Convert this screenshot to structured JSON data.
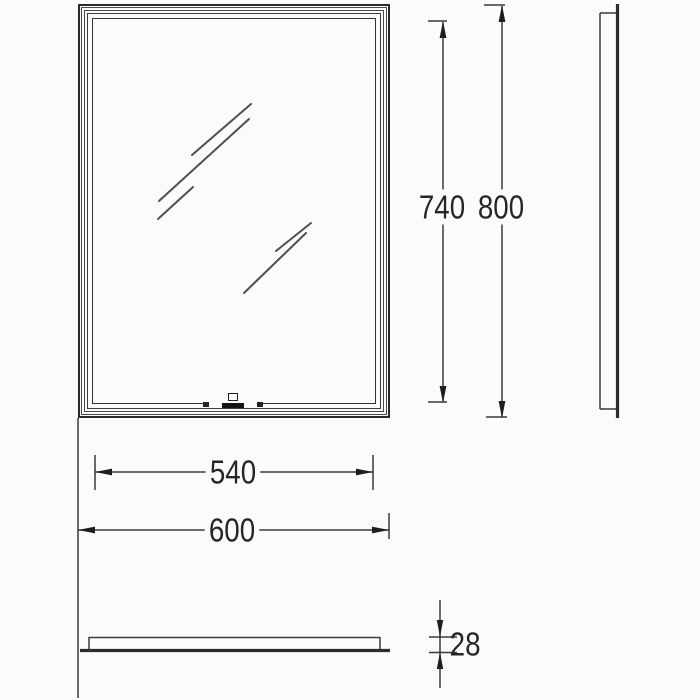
{
  "page": {
    "background_color": "#fbfbfb",
    "line_color": "#3a3a3a",
    "arrow_color": "#1e1e1e"
  },
  "drawing": {
    "type": "technical-drawing",
    "subject": "LED mirror with touch sensor — front, side and bottom views",
    "labels": {
      "inner_height": "740",
      "overall_height": "800",
      "inner_width": "540",
      "overall_width": "600",
      "depth": "28"
    }
  }
}
